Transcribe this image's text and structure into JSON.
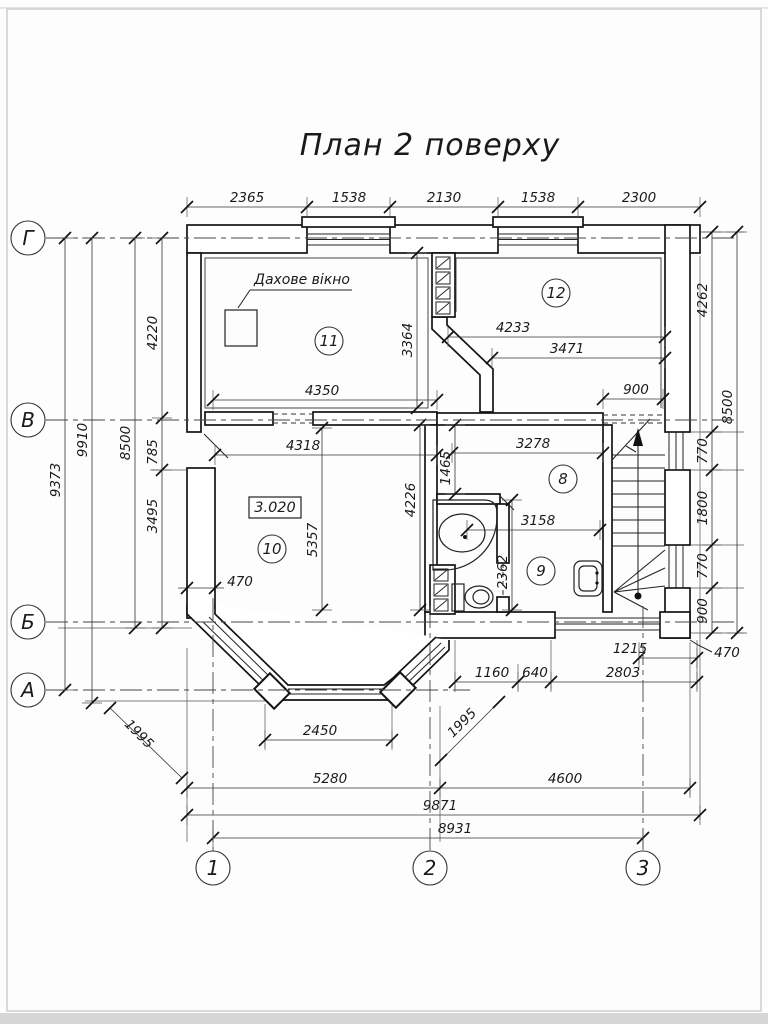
{
  "title": "План 2 поверху",
  "axis_rows": [
    {
      "label": "Г",
      "y": 238,
      "x2": 735
    },
    {
      "label": "В",
      "y": 420,
      "x2": 735
    },
    {
      "label": "Б",
      "y": 622,
      "x2": 735
    },
    {
      "label": "А",
      "y": 690,
      "x2": 470
    }
  ],
  "axis_cols": [
    {
      "label": "1",
      "x": 213,
      "y1": 598
    },
    {
      "label": "2",
      "x": 430,
      "y1": 606
    },
    {
      "label": "3",
      "x": 643,
      "y1": 606
    }
  ],
  "room_numbers": [
    {
      "n": "8",
      "x": 563,
      "y": 479
    },
    {
      "n": "9",
      "x": 541,
      "y": 571
    },
    {
      "n": "10",
      "x": 272,
      "y": 549
    },
    {
      "n": "11",
      "x": 329,
      "y": 341
    },
    {
      "n": "12",
      "x": 556,
      "y": 293
    }
  ],
  "labels": {
    "roof_window": "Дахове вікно",
    "floor_elevation": "3.020",
    "wall_thickness_left": "470",
    "wall_thickness_right": "470"
  },
  "dims": [
    {
      "o": "h",
      "y": 207,
      "ticks": [
        187,
        307,
        390,
        498,
        578,
        700
      ],
      "labels": [
        {
          "t": "2365",
          "x": 247
        },
        {
          "t": "1538",
          "x": 349
        },
        {
          "t": "2130",
          "x": 444
        },
        {
          "t": "1538",
          "x": 538
        },
        {
          "t": "2300",
          "x": 639
        }
      ]
    },
    {
      "o": "h",
      "y": 400,
      "ticks": [
        213,
        437
      ],
      "labels": [
        {
          "t": "4350",
          "x": 322
        }
      ]
    },
    {
      "o": "h",
      "y": 455,
      "ticks": [
        215,
        437
      ],
      "labels": [
        {
          "t": "4318",
          "x": 303
        }
      ]
    },
    {
      "o": "h",
      "y": 337,
      "ticks": [
        448,
        665
      ],
      "labels": [
        {
          "t": "4233",
          "x": 513
        }
      ]
    },
    {
      "o": "h",
      "y": 358,
      "ticks": [
        492,
        665
      ],
      "labels": [
        {
          "t": "3471",
          "x": 567
        }
      ]
    },
    {
      "o": "h",
      "y": 399,
      "ticks": [
        603,
        663
      ],
      "labels": [
        {
          "t": "900",
          "x": 636
        }
      ]
    },
    {
      "o": "h",
      "y": 453,
      "ticks": [
        452,
        603
      ],
      "labels": [
        {
          "t": "3278",
          "x": 533
        }
      ]
    },
    {
      "o": "h",
      "y": 530,
      "ticks": [
        467,
        600
      ],
      "labels": [
        {
          "t": "3158",
          "x": 538
        }
      ]
    },
    {
      "o": "h",
      "y": 658,
      "ticks": [
        639,
        697
      ],
      "labels": [
        {
          "t": "1215",
          "x": 630
        }
      ]
    },
    {
      "o": "h",
      "y": 682,
      "ticks": [
        455,
        518,
        551,
        697
      ],
      "labels": [
        {
          "t": "1160",
          "x": 492
        },
        {
          "t": "640",
          "x": 535
        },
        {
          "t": "2803",
          "x": 623
        }
      ]
    },
    {
      "o": "h",
      "y": 740,
      "ticks": [
        265,
        392
      ],
      "labels": [
        {
          "t": "2450",
          "x": 320
        }
      ]
    },
    {
      "o": "h",
      "y": 788,
      "ticks": [
        187,
        440,
        690
      ],
      "labels": [
        {
          "t": "5280",
          "x": 330
        },
        {
          "t": "4600",
          "x": 565
        }
      ]
    },
    {
      "o": "h",
      "y": 815,
      "ticks": [
        187,
        700
      ],
      "labels": [
        {
          "t": "9871",
          "x": 440
        }
      ]
    },
    {
      "o": "h",
      "y": 838,
      "ticks": [
        213,
        643
      ],
      "labels": [
        {
          "t": "8931",
          "x": 455
        }
      ]
    },
    {
      "o": "v",
      "x": 65,
      "ticks": [
        238,
        690
      ],
      "labels": [
        {
          "t": "9373",
          "y": 480
        }
      ]
    },
    {
      "o": "v",
      "x": 92,
      "ticks": [
        238,
        703
      ],
      "labels": [
        {
          "t": "9910",
          "y": 440
        }
      ]
    },
    {
      "o": "v",
      "x": 135,
      "ticks": [
        238,
        628
      ],
      "labels": [
        {
          "t": "8500",
          "y": 443
        }
      ]
    },
    {
      "o": "v",
      "x": 162,
      "ticks": [
        238,
        418,
        470,
        628
      ],
      "labels": [
        {
          "t": "4220",
          "y": 333
        },
        {
          "t": "785",
          "y": 452
        },
        {
          "t": "3495",
          "y": 516
        }
      ]
    },
    {
      "o": "v",
      "x": 417,
      "ticks": [
        253,
        408
      ],
      "labels": [
        {
          "t": "3364",
          "y": 340
        }
      ]
    },
    {
      "o": "v",
      "x": 455,
      "ticks": [
        425,
        494
      ],
      "labels": [
        {
          "t": "1465",
          "y": 468
        }
      ]
    },
    {
      "o": "v",
      "x": 322,
      "ticks": [
        428,
        610
      ],
      "labels": [
        {
          "t": "5357",
          "y": 540
        }
      ]
    },
    {
      "o": "v",
      "x": 420,
      "ticks": [
        425,
        610
      ],
      "labels": [
        {
          "t": "4226",
          "y": 500
        }
      ]
    },
    {
      "o": "v",
      "x": 512,
      "ticks": [
        500,
        610
      ],
      "labels": [
        {
          "t": "2362",
          "y": 572
        }
      ]
    },
    {
      "o": "v",
      "x": 712,
      "ticks": [
        232,
        432,
        470,
        545,
        588,
        633
      ],
      "labels": [
        {
          "t": "4262",
          "y": 300
        },
        {
          "t": "770",
          "y": 451
        },
        {
          "t": "1800",
          "y": 508
        },
        {
          "t": "770",
          "y": 566
        },
        {
          "t": "900",
          "y": 611
        }
      ]
    },
    {
      "o": "v",
      "x": 737,
      "ticks": [
        232,
        633
      ],
      "labels": [
        {
          "t": "8500",
          "y": 407
        }
      ]
    },
    {
      "o": "d",
      "x1": 110,
      "y1": 708,
      "x2": 182,
      "y2": 778,
      "rot": 45,
      "lx": 136,
      "ly": 737,
      "labels": [
        {
          "t": "1995"
        }
      ]
    },
    {
      "o": "d",
      "x1": 441,
      "y1": 760,
      "x2": 499,
      "y2": 702,
      "rot": -45,
      "lx": 465,
      "ly": 726,
      "labels": [
        {
          "t": "1995"
        }
      ]
    }
  ]
}
